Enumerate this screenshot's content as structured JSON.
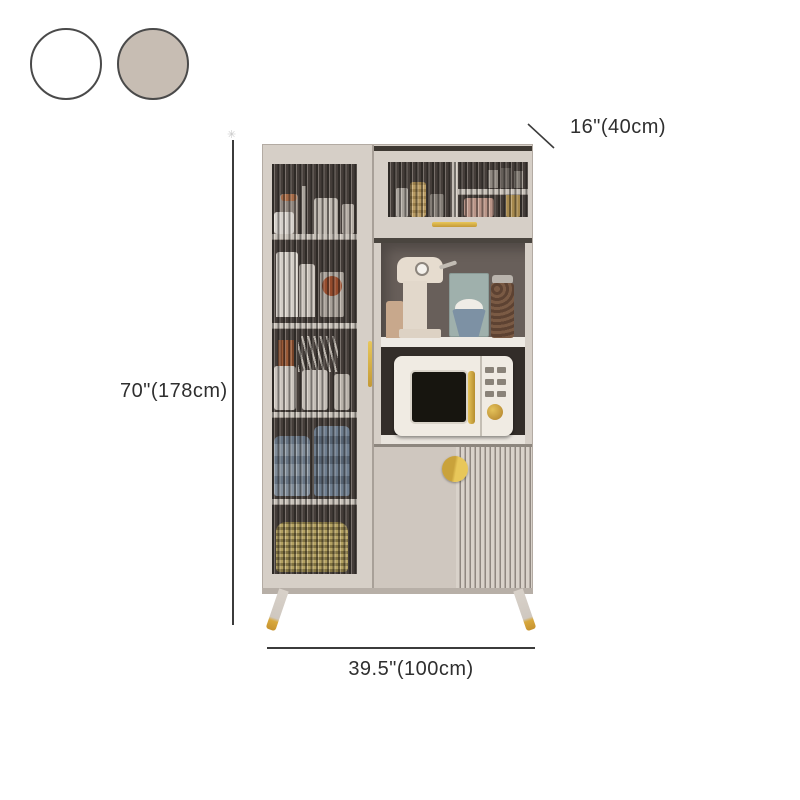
{
  "page": {
    "background": "#ffffff",
    "type": "product-dimension-diagram"
  },
  "swatches": {
    "options": [
      {
        "name": "white",
        "color": "#ffffff",
        "border": "#4a4a4a"
      },
      {
        "name": "khaki",
        "color": "#c7bdb3",
        "border": "#4a4a4a"
      }
    ]
  },
  "dimensions": {
    "depth": {
      "label": "16\"(40cm)"
    },
    "height": {
      "label": "70\"(178cm)",
      "marker": "✳"
    },
    "width": {
      "label": "39.5\"(100cm)"
    },
    "line_color": "#3b3b3b",
    "text_color": "#2f2f2f"
  },
  "product": {
    "name": "kitchen-sideboard-display-cabinet",
    "body_color": "#d6cfc7",
    "accent_gold": "#d9aa3e",
    "glass_back_color": "#453e3a",
    "open_shelf_back_color": "#685f5a",
    "niche_back_color": "#332d29",
    "contents": [
      "glassware-and-jars",
      "white-canisters",
      "kitchen-utensils",
      "blue-bowl-stacks",
      "plate-stack",
      "coffee-machine",
      "cutting-board",
      "dessert-bowl",
      "coffee-bean-jar",
      "microwave-oven"
    ]
  }
}
